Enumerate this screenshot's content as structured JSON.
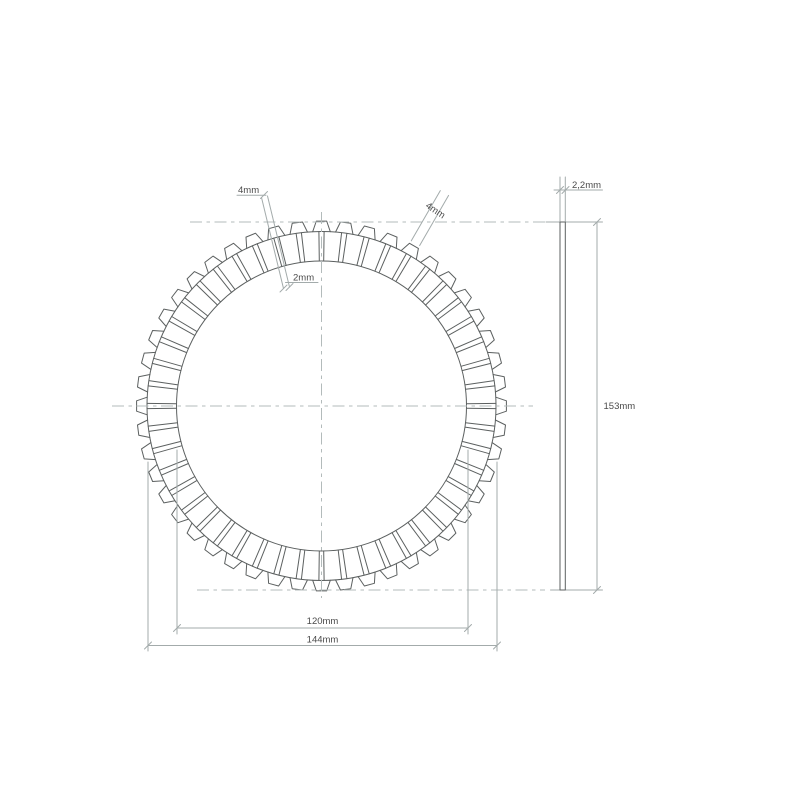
{
  "page": {
    "background_color": "#ffffff"
  },
  "drawing": {
    "kind": "clutch-friction-plate-technical-drawing",
    "colors": {
      "outline": "#5c6060",
      "dimension_lines": "#a3abab",
      "centerlines": "#b3bbbb",
      "text": "#4a4a4a"
    },
    "front_view": {
      "center_x": 321.5,
      "center_y": 406,
      "inner_radius_px": 145,
      "base_radius_px": 174.5,
      "tip_radius_px": 185,
      "teeth_count": 48,
      "tooth_pitch_deg": 7.5,
      "tooth_half_angle_base_deg": 2.9,
      "tooth_half_angle_tip_deg": 1.6,
      "groove_half_angle_deg": 0.87
    },
    "labels": {
      "tooth_width_top": "4mm",
      "tooth_width_diagonal": "4mm",
      "groove_width": "2mm",
      "thickness": "2,2mm",
      "overall_height": "153mm",
      "inner_diameter": "120mm",
      "outer_diameter": "144mm"
    }
  }
}
